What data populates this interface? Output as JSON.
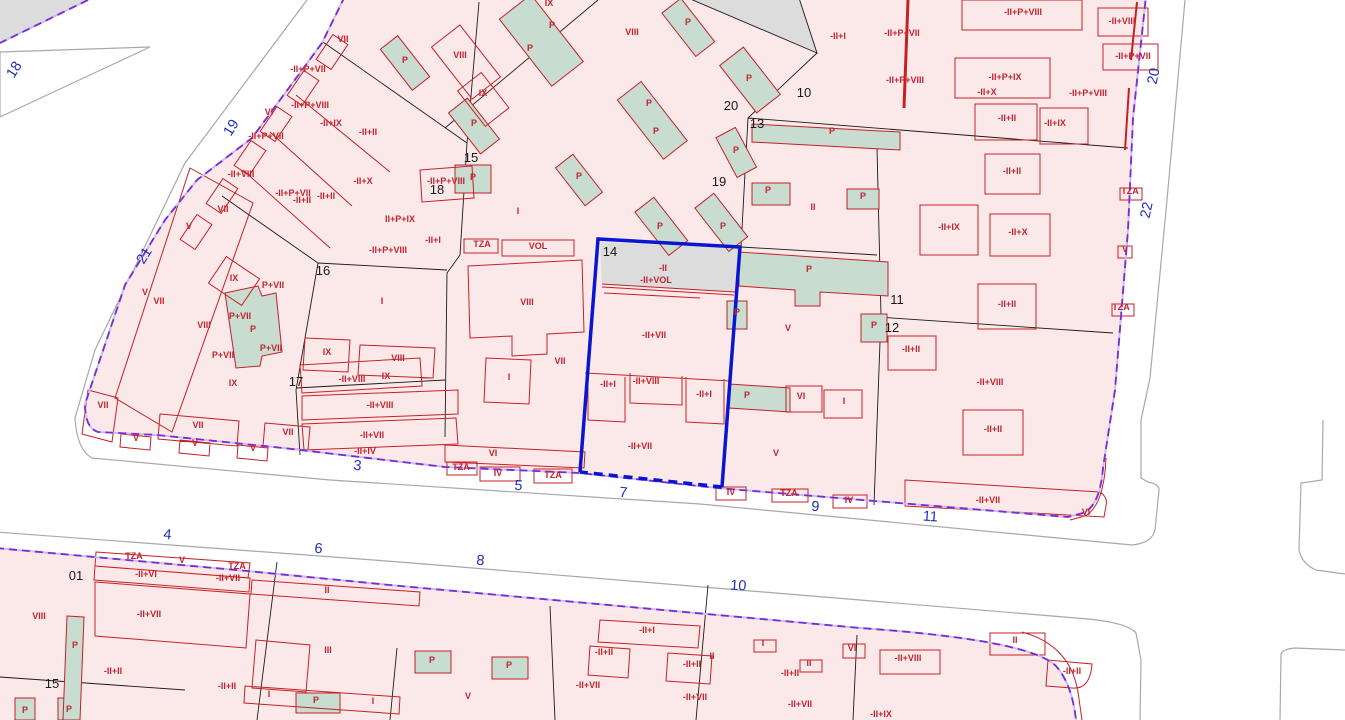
{
  "map": {
    "selected_parcel": "14",
    "colors": {
      "parcel_fill_pink": "#fbe9e9",
      "building_line_red": "#c42127",
      "height_label_red": "#c22530",
      "patio_green": "#c9dcd0",
      "street_number_blue": "#2030b8",
      "parcel_number_black": "#1a1a1a",
      "selection_blue": "#0915cf",
      "block_boundary_purple": "#7a2bd6",
      "street_curb_gray": "#a8a8a8",
      "unbuilt_gray": "#dcdcdc"
    },
    "street_numbers": [
      {
        "t": "18",
        "x": 18,
        "y": 72,
        "r": -58
      },
      {
        "t": "19",
        "x": 235,
        "y": 130,
        "r": -58
      },
      {
        "t": "21",
        "x": 148,
        "y": 258,
        "r": -58
      },
      {
        "t": "20",
        "x": 1158,
        "y": 77,
        "r": -78
      },
      {
        "t": "22",
        "x": 1151,
        "y": 211,
        "r": -78
      },
      {
        "t": "3",
        "x": 357,
        "y": 470,
        "r": 6
      },
      {
        "t": "5",
        "x": 518,
        "y": 490,
        "r": 6
      },
      {
        "t": "7",
        "x": 623,
        "y": 497,
        "r": 5
      },
      {
        "t": "9",
        "x": 815,
        "y": 511,
        "r": 4
      },
      {
        "t": "11",
        "x": 930,
        "y": 521,
        "r": 4
      },
      {
        "t": "4",
        "x": 167,
        "y": 539,
        "r": 6
      },
      {
        "t": "6",
        "x": 318,
        "y": 553,
        "r": 6
      },
      {
        "t": "8",
        "x": 480,
        "y": 565,
        "r": 5
      },
      {
        "t": "10",
        "x": 738,
        "y": 590,
        "r": 4
      }
    ],
    "parcel_numbers": [
      {
        "t": "18",
        "x": 437,
        "y": 194
      },
      {
        "t": "15",
        "x": 471,
        "y": 162
      },
      {
        "t": "16",
        "x": 323,
        "y": 275
      },
      {
        "t": "17",
        "x": 296,
        "y": 386
      },
      {
        "t": "14",
        "x": 610,
        "y": 256
      },
      {
        "t": "20",
        "x": 731,
        "y": 110
      },
      {
        "t": "10",
        "x": 804,
        "y": 97
      },
      {
        "t": "13",
        "x": 757,
        "y": 128
      },
      {
        "t": "19",
        "x": 719,
        "y": 186
      },
      {
        "t": "11",
        "x": 897,
        "y": 304
      },
      {
        "t": "12",
        "x": 892,
        "y": 332
      },
      {
        "t": "01",
        "x": 76,
        "y": 580
      },
      {
        "t": "15",
        "x": 52,
        "y": 688
      }
    ],
    "height_labels": [
      {
        "t": "VII",
        "x": 343,
        "y": 42
      },
      {
        "t": "-II+P+VII",
        "x": 308,
        "y": 72
      },
      {
        "t": "VI",
        "x": 269,
        "y": 115
      },
      {
        "t": "-II+P+VIII",
        "x": 310,
        "y": 108
      },
      {
        "t": "-II+IX",
        "x": 331,
        "y": 126
      },
      {
        "t": "-II+II",
        "x": 368,
        "y": 135
      },
      {
        "t": "-II+P+VII",
        "x": 266,
        "y": 139
      },
      {
        "t": "-II+VIII",
        "x": 241,
        "y": 177
      },
      {
        "t": "-II+X",
        "x": 363,
        "y": 184
      },
      {
        "t": "-II+P+VII",
        "x": 293,
        "y": 196
      },
      {
        "t": "-II+II",
        "x": 302,
        "y": 203
      },
      {
        "t": "-II+II",
        "x": 326,
        "y": 199
      },
      {
        "t": "VII",
        "x": 223,
        "y": 212
      },
      {
        "t": "V",
        "x": 189,
        "y": 229
      },
      {
        "t": "-II+P+VIII",
        "x": 446,
        "y": 184
      },
      {
        "t": "II+P+IX",
        "x": 400,
        "y": 222
      },
      {
        "t": "-II+I",
        "x": 433,
        "y": 243
      },
      {
        "t": "-II+P+VIII",
        "x": 388,
        "y": 253
      },
      {
        "t": "V",
        "x": 145,
        "y": 295
      },
      {
        "t": "VII",
        "x": 159,
        "y": 304
      },
      {
        "t": "IX",
        "x": 234,
        "y": 281
      },
      {
        "t": "P+VII",
        "x": 273,
        "y": 288
      },
      {
        "t": "VIII",
        "x": 204,
        "y": 328
      },
      {
        "t": "P+VII",
        "x": 240,
        "y": 319
      },
      {
        "t": "P",
        "x": 253,
        "y": 332
      },
      {
        "t": "P+VII",
        "x": 271,
        "y": 351
      },
      {
        "t": "P+VII",
        "x": 223,
        "y": 358
      },
      {
        "t": "IX",
        "x": 233,
        "y": 386
      },
      {
        "t": "VII",
        "x": 103,
        "y": 408
      },
      {
        "t": "VII",
        "x": 198,
        "y": 428
      },
      {
        "t": "V",
        "x": 136,
        "y": 441
      },
      {
        "t": "V",
        "x": 195,
        "y": 446
      },
      {
        "t": "V",
        "x": 253,
        "y": 451
      },
      {
        "t": "VII",
        "x": 288,
        "y": 435
      },
      {
        "t": "I",
        "x": 382,
        "y": 304
      },
      {
        "t": "IX",
        "x": 327,
        "y": 355
      },
      {
        "t": "VIII",
        "x": 398,
        "y": 361
      },
      {
        "t": "-II+VIII",
        "x": 352,
        "y": 382
      },
      {
        "t": "IX",
        "x": 386,
        "y": 379
      },
      {
        "t": "-II+VIII",
        "x": 380,
        "y": 408
      },
      {
        "t": "-II+VII",
        "x": 372,
        "y": 438
      },
      {
        "t": "-II+IV",
        "x": 365,
        "y": 454
      },
      {
        "t": "VI",
        "x": 493,
        "y": 456
      },
      {
        "t": "TZA",
        "x": 461,
        "y": 470
      },
      {
        "t": "IV",
        "x": 498,
        "y": 476
      },
      {
        "t": "TZA",
        "x": 553,
        "y": 478
      },
      {
        "t": "VIII",
        "x": 460,
        "y": 58
      },
      {
        "t": "IX",
        "x": 483,
        "y": 96
      },
      {
        "t": "P",
        "x": 405,
        "y": 63
      },
      {
        "t": "P",
        "x": 474,
        "y": 126
      },
      {
        "t": "P",
        "x": 473,
        "y": 180
      },
      {
        "t": "I",
        "x": 518,
        "y": 214
      },
      {
        "t": "TZA",
        "x": 482,
        "y": 247
      },
      {
        "t": "VOL",
        "x": 538,
        "y": 249
      },
      {
        "t": "VIII",
        "x": 527,
        "y": 305
      },
      {
        "t": "VII",
        "x": 560,
        "y": 364
      },
      {
        "t": "I",
        "x": 509,
        "y": 380
      },
      {
        "t": "IX",
        "x": 549,
        "y": 6
      },
      {
        "t": "P",
        "x": 552,
        "y": 28
      },
      {
        "t": "P",
        "x": 530,
        "y": 51
      },
      {
        "t": "VIII",
        "x": 632,
        "y": 35
      },
      {
        "t": "P",
        "x": 688,
        "y": 25
      },
      {
        "t": "P",
        "x": 749,
        "y": 81
      },
      {
        "t": "P",
        "x": 649,
        "y": 106
      },
      {
        "t": "P",
        "x": 656,
        "y": 134
      },
      {
        "t": "P",
        "x": 579,
        "y": 179
      },
      {
        "t": "P",
        "x": 736,
        "y": 153
      },
      {
        "t": "P",
        "x": 660,
        "y": 229
      },
      {
        "t": "P",
        "x": 723,
        "y": 229
      },
      {
        "t": "P",
        "x": 768,
        "y": 193
      },
      {
        "t": "P",
        "x": 832,
        "y": 134
      },
      {
        "t": "P",
        "x": 863,
        "y": 199
      },
      {
        "t": "II",
        "x": 813,
        "y": 210
      },
      {
        "t": "-II+I",
        "x": 838,
        "y": 39
      },
      {
        "t": "-II+P+VII",
        "x": 902,
        "y": 36
      },
      {
        "t": "-II+P+VIII",
        "x": 905,
        "y": 83
      },
      {
        "t": "-II",
        "x": 663,
        "y": 271
      },
      {
        "t": "-II+VOL",
        "x": 656,
        "y": 283
      },
      {
        "t": "-II+VII",
        "x": 654,
        "y": 338
      },
      {
        "t": "-II+I",
        "x": 608,
        "y": 387
      },
      {
        "t": "-II+VIII",
        "x": 646,
        "y": 384
      },
      {
        "t": "-II+I",
        "x": 704,
        "y": 397
      },
      {
        "t": "-II+VII",
        "x": 640,
        "y": 449
      },
      {
        "t": "P",
        "x": 809,
        "y": 272
      },
      {
        "t": "V",
        "x": 788,
        "y": 331
      },
      {
        "t": "P",
        "x": 737,
        "y": 315
      },
      {
        "t": "P",
        "x": 747,
        "y": 398
      },
      {
        "t": "VI",
        "x": 801,
        "y": 399
      },
      {
        "t": "I",
        "x": 844,
        "y": 404
      },
      {
        "t": "V",
        "x": 776,
        "y": 456
      },
      {
        "t": "IV",
        "x": 731,
        "y": 495
      },
      {
        "t": "TZA",
        "x": 789,
        "y": 496
      },
      {
        "t": "IV",
        "x": 849,
        "y": 503
      },
      {
        "t": "-II+P+VIII",
        "x": 1023,
        "y": 15
      },
      {
        "t": "-II+VIII",
        "x": 1122,
        "y": 24
      },
      {
        "t": "-II+P+VII",
        "x": 1133,
        "y": 59
      },
      {
        "t": "-II+P+IX",
        "x": 1005,
        "y": 80
      },
      {
        "t": "-II+X",
        "x": 987,
        "y": 95
      },
      {
        "t": "-II+P+VIII",
        "x": 1088,
        "y": 96
      },
      {
        "t": "-II+II",
        "x": 1007,
        "y": 121
      },
      {
        "t": "-II+IX",
        "x": 1055,
        "y": 126
      },
      {
        "t": "-II+II",
        "x": 1012,
        "y": 174
      },
      {
        "t": "TZA",
        "x": 1130,
        "y": 194
      },
      {
        "t": "-II+IX",
        "x": 949,
        "y": 230
      },
      {
        "t": "-II+X",
        "x": 1018,
        "y": 235
      },
      {
        "t": "P",
        "x": 874,
        "y": 328
      },
      {
        "t": "-II+II",
        "x": 911,
        "y": 352
      },
      {
        "t": "-II+II",
        "x": 1007,
        "y": 307
      },
      {
        "t": "-II+VIII",
        "x": 990,
        "y": 385
      },
      {
        "t": "-II+II",
        "x": 993,
        "y": 432
      },
      {
        "t": "-II+VII",
        "x": 988,
        "y": 503
      },
      {
        "t": "VI",
        "x": 1086,
        "y": 515
      },
      {
        "t": "V",
        "x": 1125,
        "y": 252
      },
      {
        "t": "TZA",
        "x": 1121,
        "y": 310
      },
      {
        "t": "TZA",
        "x": 134,
        "y": 559
      },
      {
        "t": "V",
        "x": 182,
        "y": 563
      },
      {
        "t": "TZA",
        "x": 237,
        "y": 569
      },
      {
        "t": "-II+VI",
        "x": 146,
        "y": 577
      },
      {
        "t": "-II+VII",
        "x": 228,
        "y": 581
      },
      {
        "t": "II",
        "x": 327,
        "y": 593
      },
      {
        "t": "VIII",
        "x": 39,
        "y": 619
      },
      {
        "t": "-II+VII",
        "x": 149,
        "y": 617
      },
      {
        "t": "P",
        "x": 75,
        "y": 648
      },
      {
        "t": "-II+II",
        "x": 113,
        "y": 674
      },
      {
        "t": "III",
        "x": 328,
        "y": 653
      },
      {
        "t": "-II+II",
        "x": 227,
        "y": 689
      },
      {
        "t": "P",
        "x": 25,
        "y": 713
      },
      {
        "t": "P",
        "x": 69,
        "y": 712
      },
      {
        "t": "I",
        "x": 269,
        "y": 697
      },
      {
        "t": "P",
        "x": 316,
        "y": 703
      },
      {
        "t": "I",
        "x": 373,
        "y": 704
      },
      {
        "t": "P",
        "x": 432,
        "y": 663
      },
      {
        "t": "P",
        "x": 509,
        "y": 668
      },
      {
        "t": "V",
        "x": 468,
        "y": 699
      },
      {
        "t": "-II+I",
        "x": 647,
        "y": 633
      },
      {
        "t": "-II+II",
        "x": 604,
        "y": 655
      },
      {
        "t": "II",
        "x": 712,
        "y": 659
      },
      {
        "t": "-II+II",
        "x": 692,
        "y": 667
      },
      {
        "t": "I",
        "x": 763,
        "y": 646
      },
      {
        "t": "-II+VII",
        "x": 588,
        "y": 688
      },
      {
        "t": "-II+VII",
        "x": 695,
        "y": 700
      },
      {
        "t": "II",
        "x": 809,
        "y": 666
      },
      {
        "t": "-II+II",
        "x": 790,
        "y": 676
      },
      {
        "t": "-II+VII",
        "x": 800,
        "y": 707
      },
      {
        "t": "VI",
        "x": 852,
        "y": 651
      },
      {
        "t": "-II+VIII",
        "x": 908,
        "y": 661
      },
      {
        "t": "II",
        "x": 1015,
        "y": 643
      },
      {
        "t": "-II+II",
        "x": 1072,
        "y": 674
      },
      {
        "t": "-II+IX",
        "x": 881,
        "y": 717
      }
    ]
  }
}
